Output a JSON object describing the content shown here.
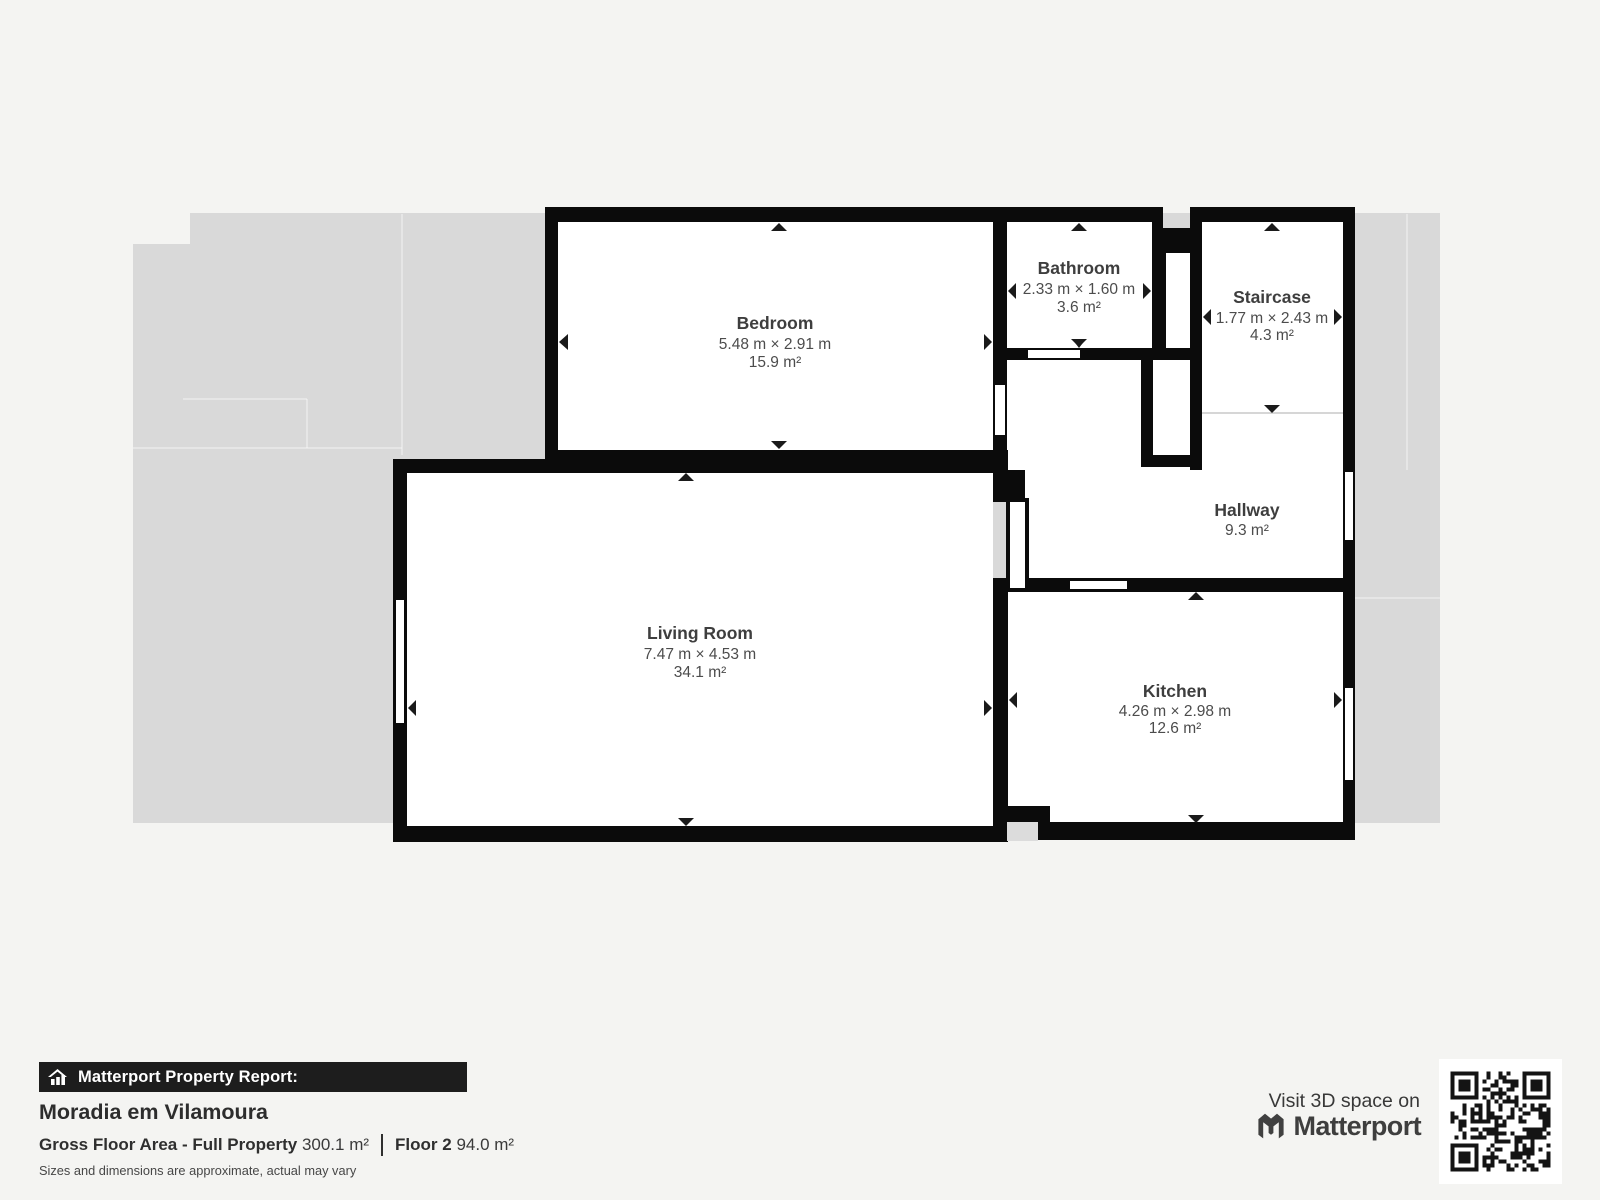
{
  "plan": {
    "rooms": {
      "bedroom": {
        "name": "Bedroom",
        "dimensions": "5.48 m × 2.91 m",
        "area": "15.9 m²"
      },
      "bathroom": {
        "name": "Bathroom",
        "dimensions": "2.33 m × 1.60 m",
        "area": "3.6 m²"
      },
      "staircase": {
        "name": "Staircase",
        "dimensions": "1.77 m × 2.43 m",
        "area": "4.3 m²"
      },
      "hallway": {
        "name": "Hallway",
        "area": "9.3 m²"
      },
      "living_room": {
        "name": "Living Room",
        "dimensions": "7.47 m × 4.53 m",
        "area": "34.1 m²"
      },
      "kitchen": {
        "name": "Kitchen",
        "dimensions": "4.26 m × 2.98 m",
        "area": "12.6 m²"
      }
    },
    "colors": {
      "wall": "#0b0b0b",
      "floor": "#ffffff",
      "underlay": "#d9d9d9",
      "background": "#f4f4f2",
      "label_text": "#3e3e3e"
    }
  },
  "footer": {
    "report_label": "Matterport Property Report:",
    "property_name": "Moradia em Vilamoura",
    "gross_floor_area_label": "Gross Floor Area - Full Property",
    "gross_floor_area_value": "300.1 m²",
    "floor_label": "Floor 2",
    "floor_value": "94.0 m²",
    "disclaimer": "Sizes and dimensions are approximate, actual may vary",
    "visit_text": "Visit 3D space on",
    "brand": "Matterport"
  }
}
